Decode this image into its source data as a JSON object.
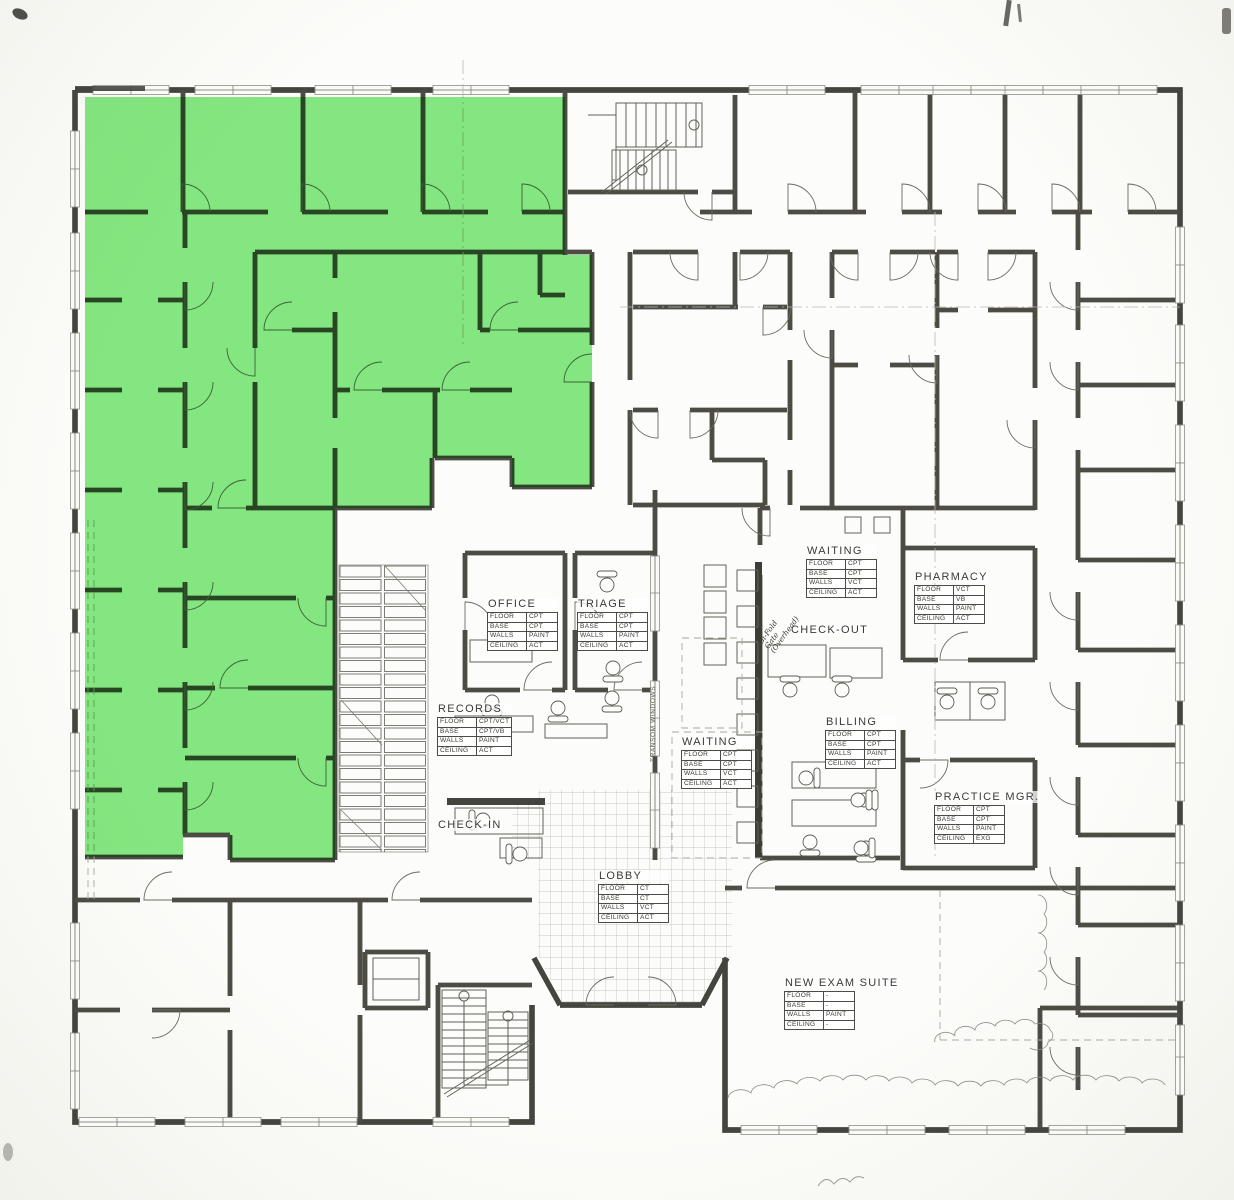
{
  "drawing": {
    "paper_color": "#fafaf6",
    "line_color": "#4c4c45",
    "highlight_color": "#7ce878"
  },
  "labels": {
    "transom_windows": "TRANSOM WINDOWS",
    "handwritten_note": "Bi-Fold\nGate\n(Overhead)"
  },
  "schedule_row_keys": [
    "FLOOR",
    "BASE",
    "WALLS",
    "CEILING"
  ],
  "rooms": [
    {
      "name": "office",
      "label": "OFFICE",
      "x": 487,
      "y": 598,
      "table": true,
      "finishes": [
        "CPT",
        "CPT",
        "PAINT",
        "ACT"
      ]
    },
    {
      "name": "triage",
      "label": "TRIAGE",
      "x": 577,
      "y": 598,
      "table": true,
      "finishes": [
        "CPT",
        "CPT",
        "PAINT",
        "ACT"
      ]
    },
    {
      "name": "records",
      "label": "RECORDS",
      "x": 437,
      "y": 703,
      "table": true,
      "finishes": [
        "CPT/VCT",
        "CPT/VB",
        "PAINT",
        "ACT"
      ]
    },
    {
      "name": "waiting-upper",
      "label": "WAITING",
      "x": 806,
      "y": 545,
      "table": true,
      "finishes": [
        "CPT",
        "CPT",
        "VCT",
        "ACT"
      ]
    },
    {
      "name": "check-out",
      "label": "CHECK-OUT",
      "x": 790,
      "y": 624,
      "table": false,
      "finishes": []
    },
    {
      "name": "waiting-lower",
      "label": "WAITING",
      "x": 681,
      "y": 736,
      "table": true,
      "finishes": [
        "CPT",
        "CPT",
        "VCT",
        "ACT"
      ]
    },
    {
      "name": "billing",
      "label": "BILLING",
      "x": 825,
      "y": 716,
      "table": true,
      "finishes": [
        "CPT",
        "CPT",
        "PAINT",
        "ACT"
      ]
    },
    {
      "name": "pharmacy",
      "label": "PHARMACY",
      "x": 914,
      "y": 571,
      "table": true,
      "finishes": [
        "VCT",
        "VB",
        "PAINT",
        "ACT"
      ]
    },
    {
      "name": "practice-mgr",
      "label": "PRACTICE MGR.",
      "x": 934,
      "y": 791,
      "table": true,
      "finishes": [
        "CPT",
        "CPT",
        "PAINT",
        "EXG"
      ]
    },
    {
      "name": "check-in",
      "label": "CHECK-IN",
      "x": 437,
      "y": 819,
      "table": false,
      "finishes": []
    },
    {
      "name": "lobby",
      "label": "LOBBY",
      "x": 598,
      "y": 870,
      "table": true,
      "finishes": [
        "CT",
        "CT",
        "VCT",
        "ACT"
      ]
    },
    {
      "name": "new-exam-suite",
      "label": "NEW EXAM SUITE",
      "x": 784,
      "y": 977,
      "table": true,
      "finishes": [
        "-",
        "-",
        "PAINT",
        "-"
      ]
    }
  ]
}
